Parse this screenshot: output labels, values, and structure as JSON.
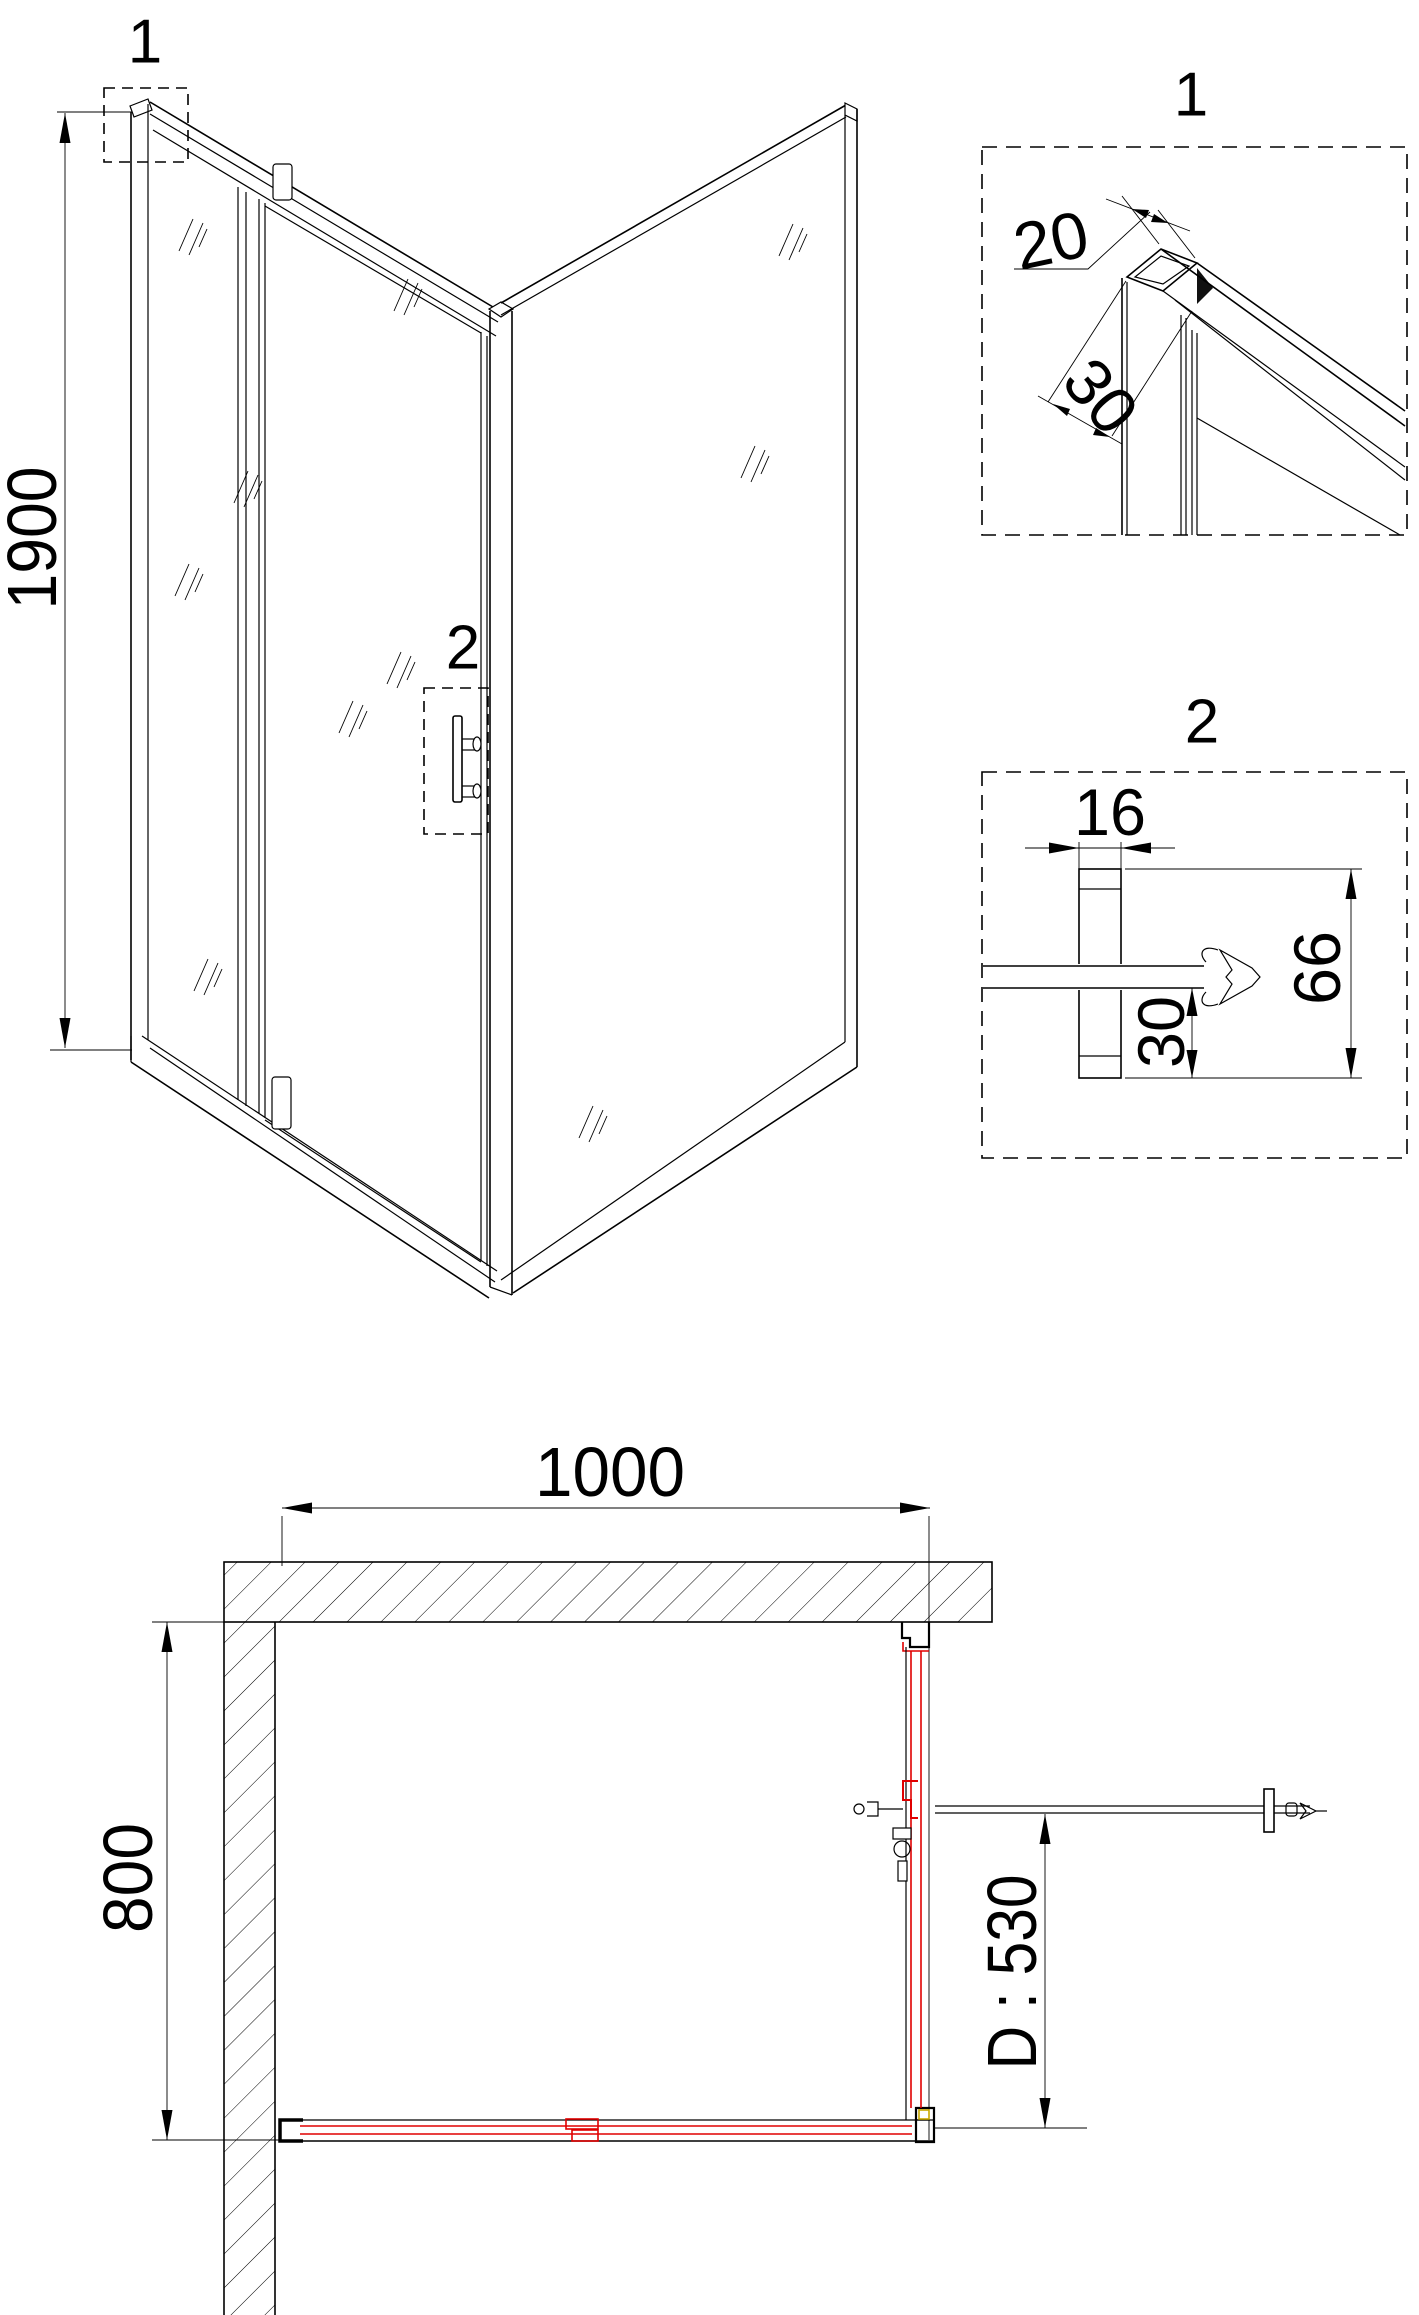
{
  "colors": {
    "line": "#000000",
    "accent_red": "#e00000",
    "accent_gold": "#c8a800",
    "background": "#ffffff"
  },
  "iso_view": {
    "height_dim": "1900",
    "marker1": "1",
    "marker2": "2"
  },
  "detail_1": {
    "title": "1",
    "dim_width": "20",
    "dim_depth": "30"
  },
  "detail_2": {
    "title": "2",
    "dim_width": "16",
    "dim_bottom": "30",
    "dim_height": "66"
  },
  "plan_view": {
    "dim_width": "1000",
    "dim_depth": "800",
    "dim_door": "D : 530"
  }
}
